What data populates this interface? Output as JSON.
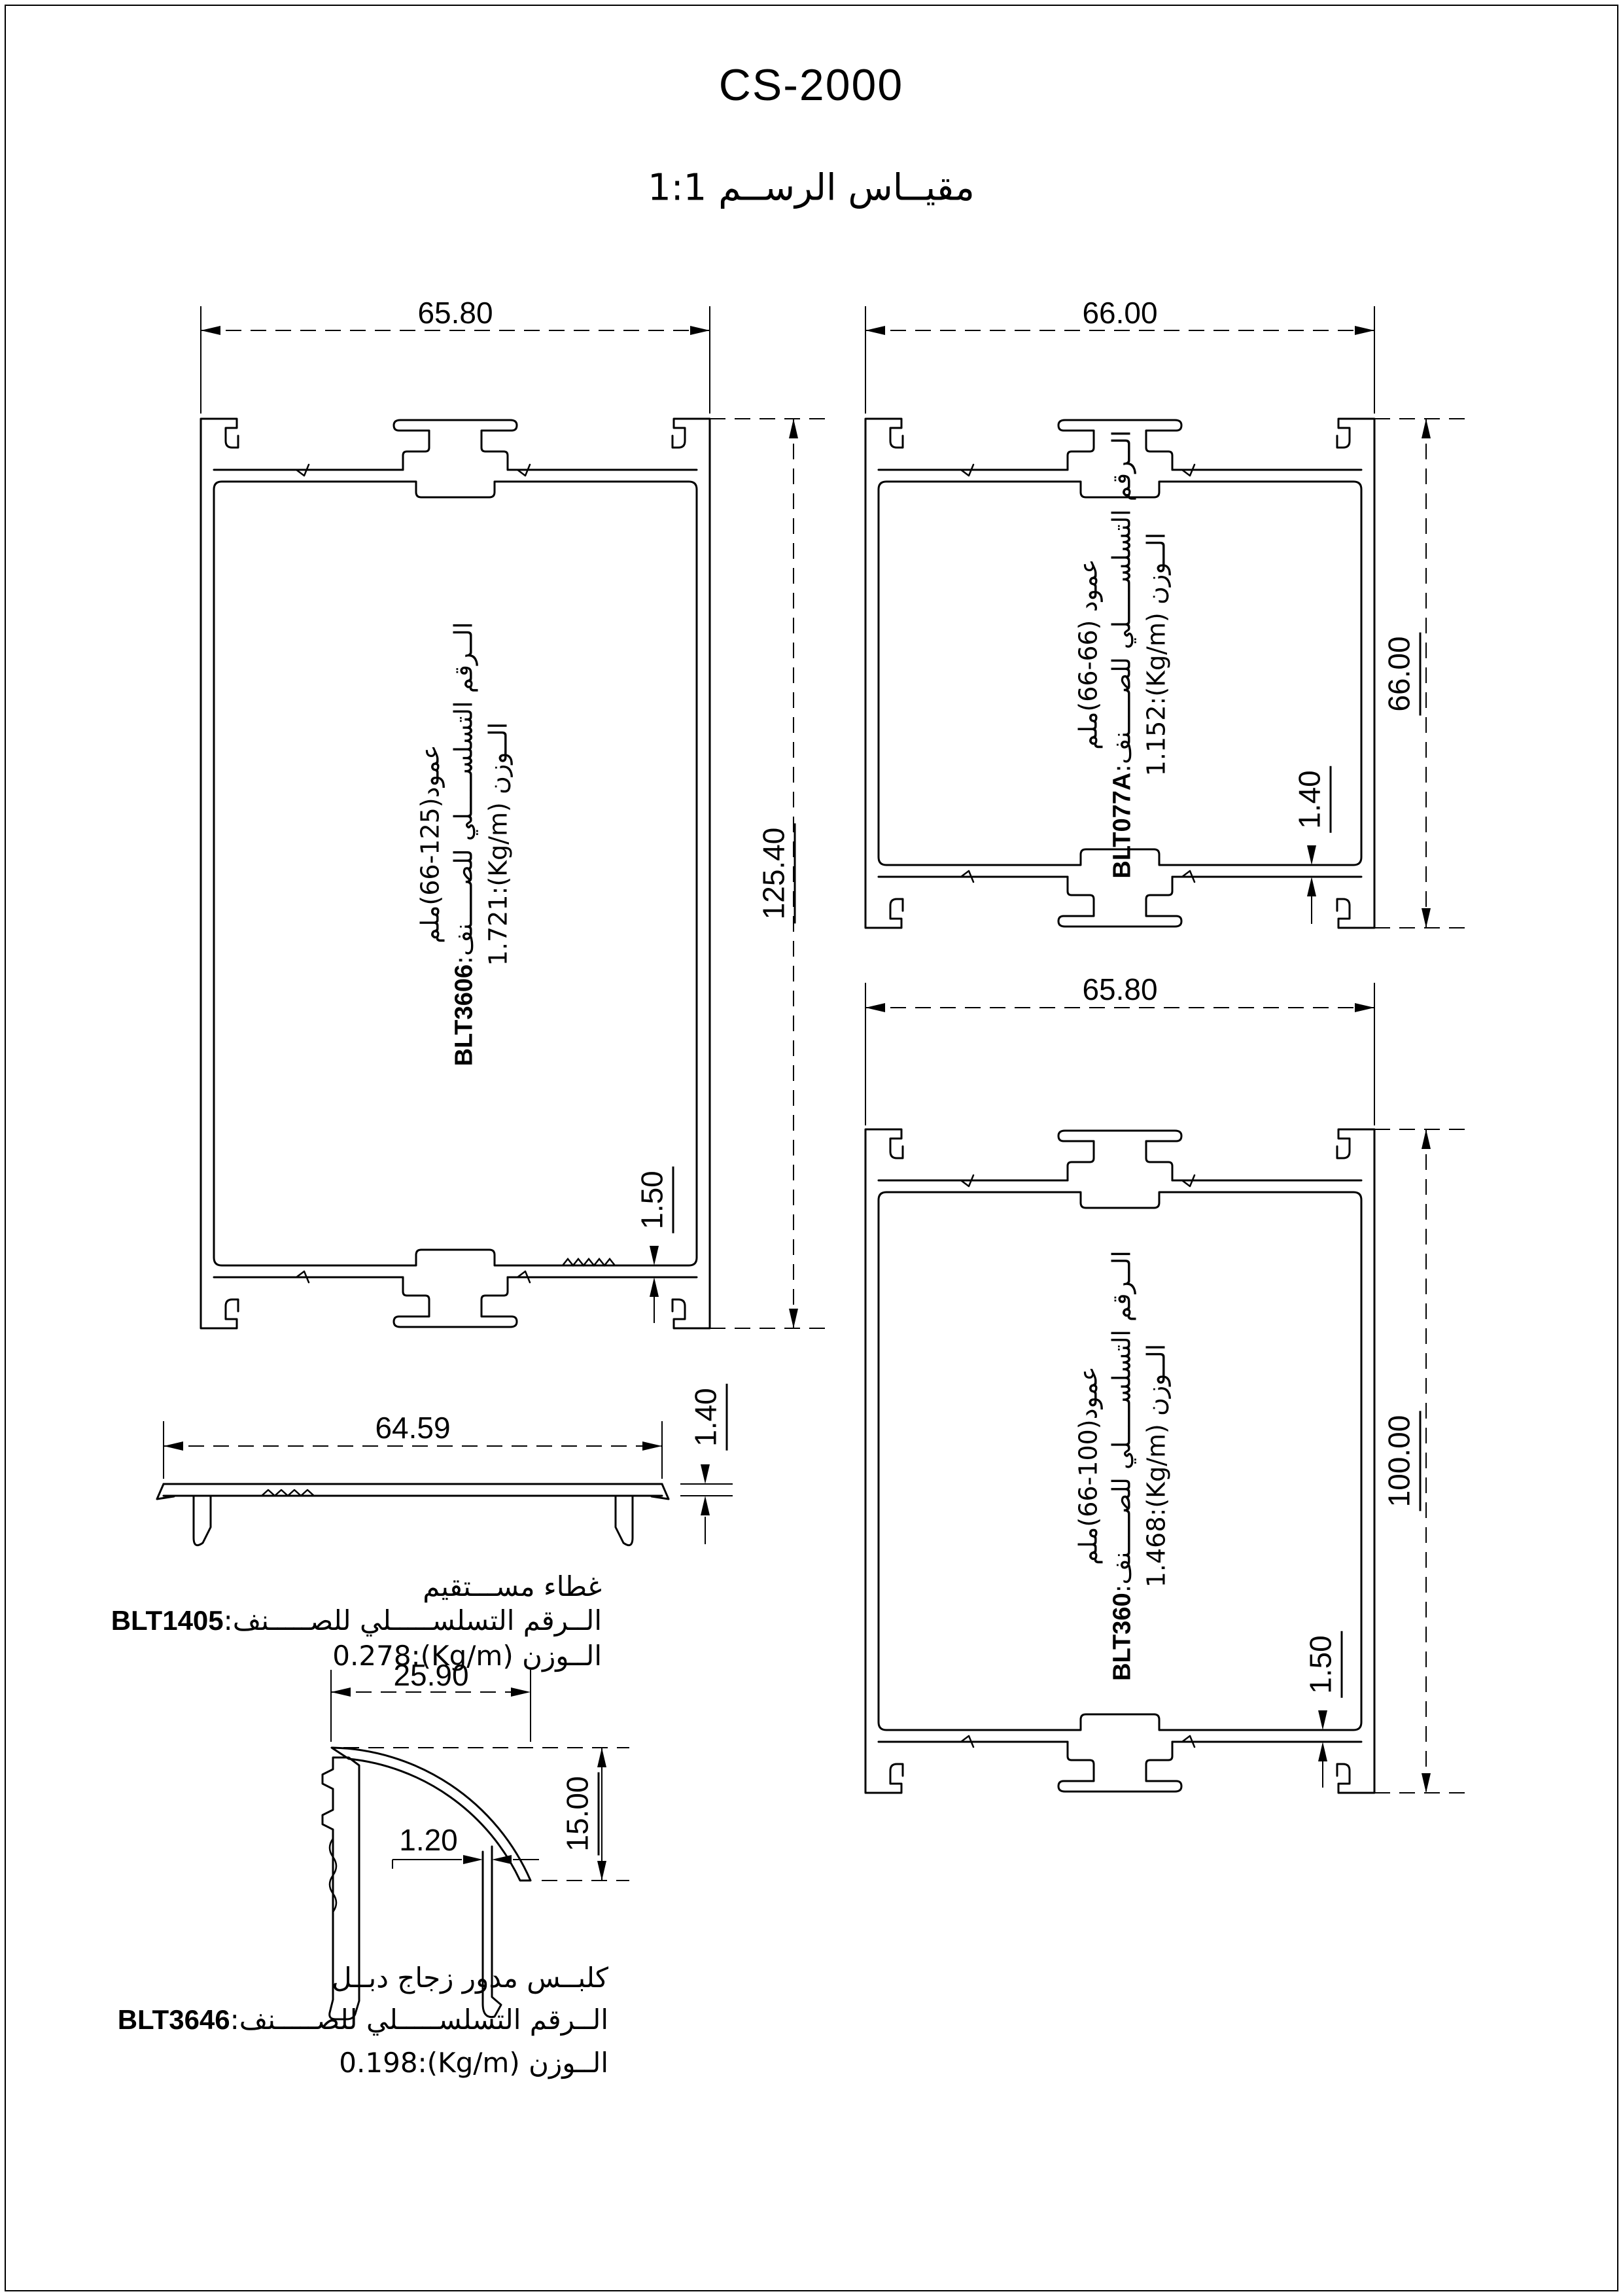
{
  "page": {
    "title": "CS-2000",
    "subtitle": "مقيــاس الرســم 1:1"
  },
  "labels": {
    "serial_label": "الــرقم التسلســـــلي للصـــــنف:",
    "weight_label": "الــوزن"
  },
  "profiles": {
    "blt3606": {
      "name": "عمود(125-66)ملم",
      "serial": "BLT3606",
      "weight": "1.721:(Kg/m)",
      "width": "65.80",
      "height": "125.40",
      "wall": "1.50"
    },
    "blt077a": {
      "name": "عمود (66-66)ملم",
      "serial": "BLT077A",
      "weight": "1.152:(Kg/m)",
      "width": "66.00",
      "height": "66.00",
      "wall": "1.40"
    },
    "blt360": {
      "name": "عمود(100-66)ملم",
      "serial": "BLT360",
      "weight": "1.468:(Kg/m)",
      "width": "65.80",
      "height": "100.00",
      "wall": "1.50"
    },
    "blt1405": {
      "name": "غطاء مســـتقيم",
      "serial": "BLT1405",
      "weight": "0.278:(Kg/m)",
      "width": "64.59",
      "thickness": "1.40"
    },
    "blt3646": {
      "name": "كلبــس مدور زجاج دبــل",
      "serial": "BLT3646",
      "weight": "0.198:(Kg/m)",
      "width": "25.90",
      "height": "15.00",
      "wall": "1.20"
    }
  }
}
